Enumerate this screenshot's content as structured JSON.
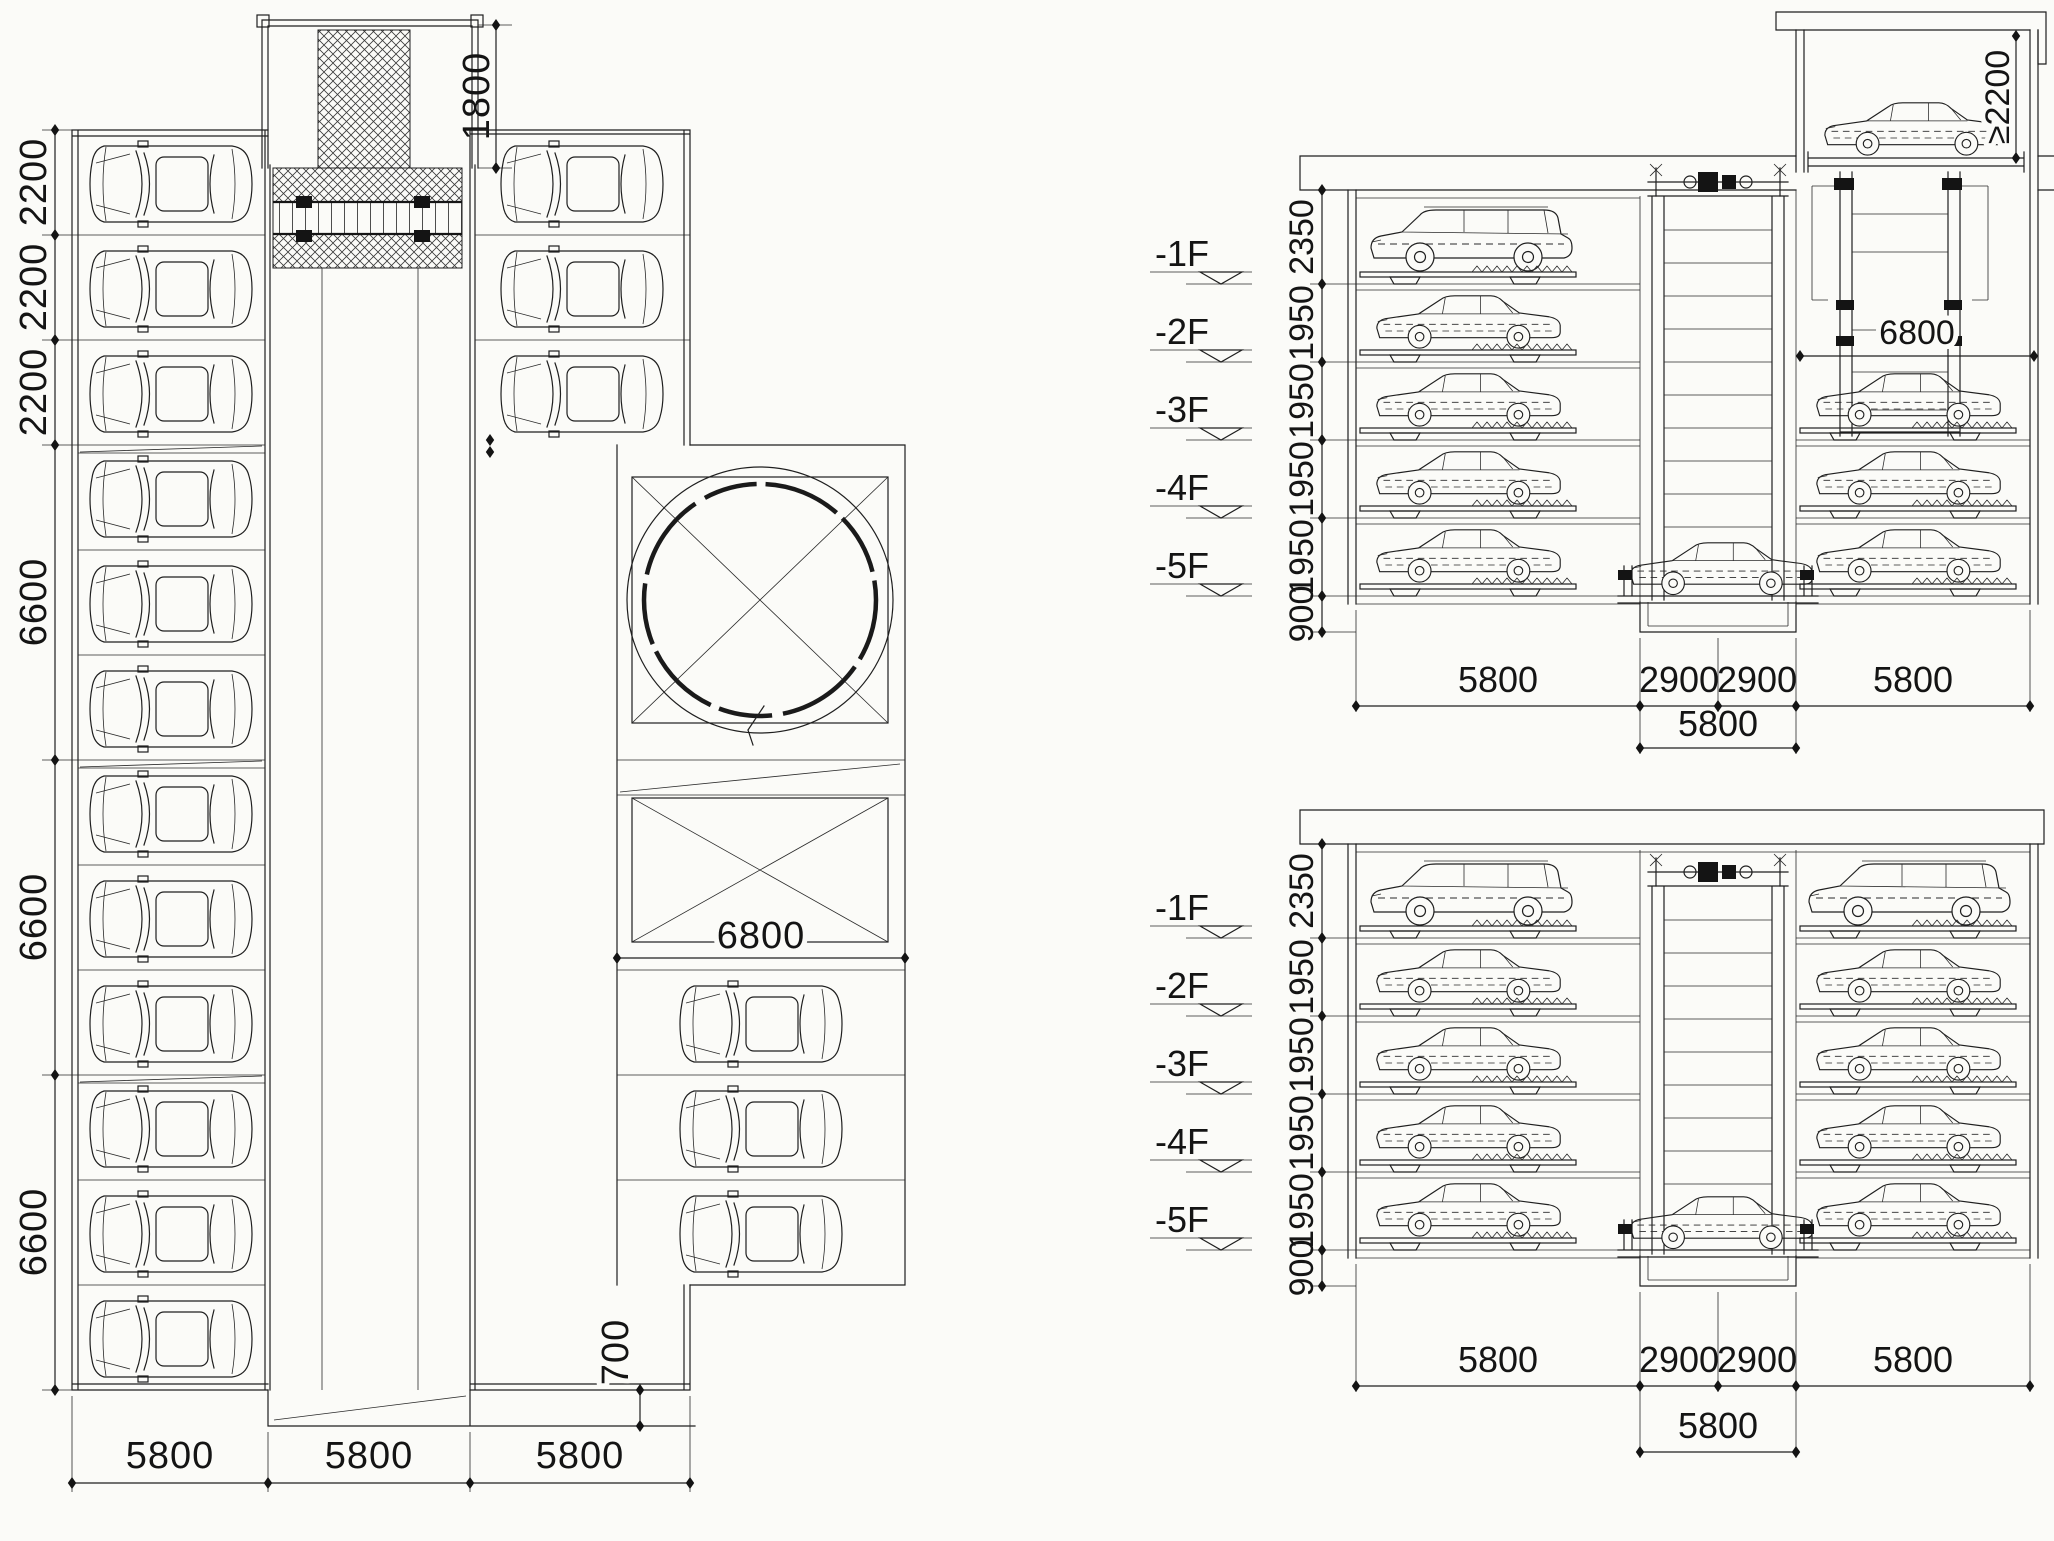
{
  "drawing": {
    "type": "parking-system-cad-drawing",
    "views": [
      "plan-view",
      "upper-cross-section",
      "lower-cross-section"
    ]
  },
  "plan": {
    "left_dims": [
      "2200",
      "2200",
      "2200",
      "6600",
      "6600",
      "6600"
    ],
    "top_dim": "1800",
    "bay_dim": "6800",
    "door_dim": "700",
    "bottom_dims": [
      "5800",
      "5800",
      "5800"
    ]
  },
  "section_top": {
    "levels": [
      "-1F",
      "-2F",
      "-3F",
      "-4F",
      "-5F"
    ],
    "height_dims": [
      "2350",
      "1950",
      "1950",
      "1950",
      "1950",
      "900"
    ],
    "width_dims": [
      "5800",
      "2900",
      "2900",
      "5800"
    ],
    "width_total": "5800",
    "entry_clearance": "≥2200",
    "pit_width": "6800"
  },
  "section_bottom": {
    "levels": [
      "-1F",
      "-2F",
      "-3F",
      "-4F",
      "-5F"
    ],
    "height_dims": [
      "2350",
      "1950",
      "1950",
      "1950",
      "1950",
      "900"
    ],
    "width_dims": [
      "5800",
      "2900",
      "2900",
      "5800"
    ],
    "width_total": "5800"
  }
}
